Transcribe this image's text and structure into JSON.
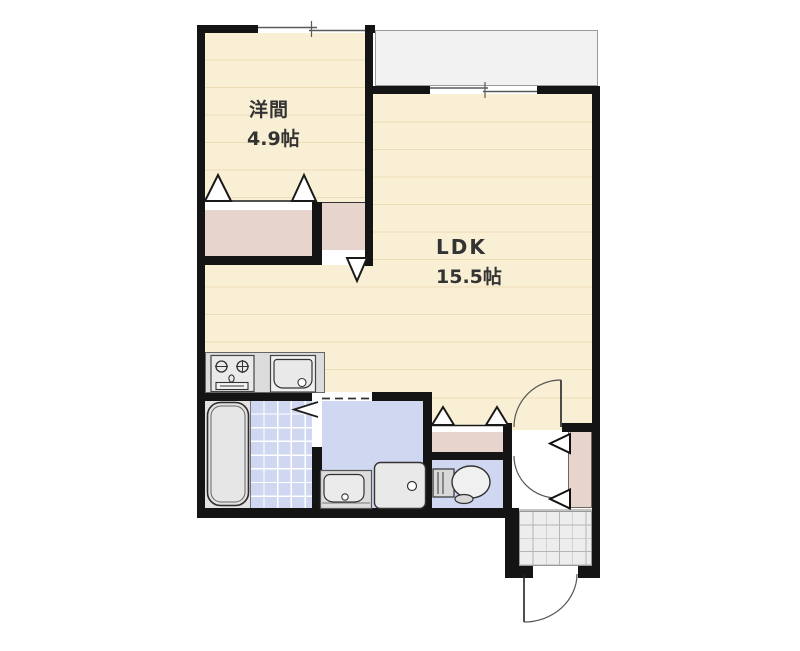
{
  "plan": {
    "type": "apartment-floorplan",
    "rooms": [
      {
        "key": "western_room",
        "label": "洋間",
        "area": "4.9帖"
      },
      {
        "key": "ldk",
        "label": "LDK",
        "area": "15.5帖"
      }
    ],
    "fixtures": [
      "balcony",
      "sliding-window",
      "bifold-closet-door",
      "closet",
      "kitchen-stove",
      "kitchen-sink",
      "bathtub",
      "bathroom-tile-floor",
      "bathroom-folding-door",
      "washbasin",
      "washing-machine-pan",
      "toilet",
      "interior-door",
      "entry-hall",
      "shoe-cabinet",
      "entrance-porch",
      "entrance-door"
    ],
    "colors": {
      "wall": "#141414",
      "room_floor": "#f9efd4",
      "floor_stripe": "#ecdcb8",
      "closet": "#e7d5cd",
      "wet_area": "#cfd8f0",
      "balcony": "#f2f2f2",
      "porch_tile": "#ededed",
      "fixture_gray": "#e0e0e0"
    }
  }
}
